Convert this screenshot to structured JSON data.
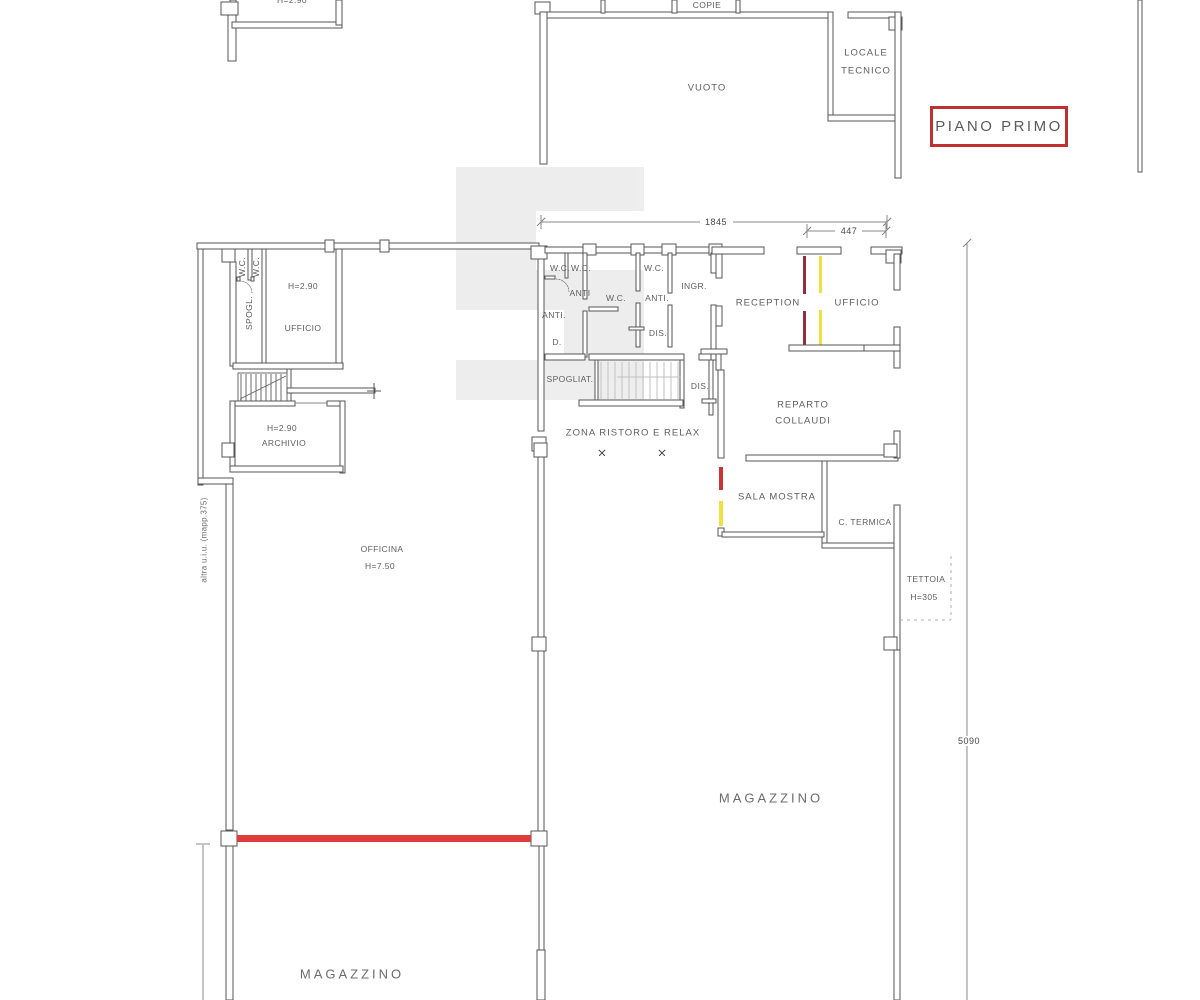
{
  "title_badge": {
    "label": "PIANO PRIMO"
  },
  "colors": {
    "title_border": "#c13030",
    "wall_line": "#565656",
    "demolition_dark_red": "#8e3039",
    "new_work_yellow": "#f2e13c",
    "highlight_red": "#e03c3c",
    "watermark_gray": "#d9d9d9"
  },
  "dimensions": {
    "top_width": "1845",
    "office_width": "447",
    "right_height": "5090"
  },
  "rooms": {
    "copie": "COPIE",
    "vuoto": "VUOTO",
    "locale_tecnico_line1": "LOCALE",
    "locale_tecnico_line2": "TECNICO",
    "height_top_left": "H=2.90",
    "wc_a": "W.C.",
    "wc_b": "W.C.",
    "spogl": "SPOGL.",
    "ufficio_left_height": "H=2.90",
    "ufficio_left": "UFFICIO",
    "archivio_height": "H=2.90",
    "archivio": "ARCHIVIO",
    "officina": "OFFICINA",
    "officina_height": "H=7.50",
    "wc_c": "W.C.",
    "wc_d": "W.C.",
    "anti_a": "ANTI",
    "anti_b": "ANTI.",
    "d_room": "D.",
    "wc_e": "W.C.",
    "wc_f": "W.C.",
    "anti_c": "ANTI.",
    "ingresso": "INGR.",
    "dis_a": "DIS.",
    "spogliatoio": "SPOGLIAT.",
    "dis_b": "DIS.",
    "zona_ristoro": "ZONA RISTORO E RELAX",
    "reception": "RECEPTION",
    "ufficio_right": "UFFICIO",
    "reparto_line1": "REPARTO",
    "reparto_line2": "COLLAUDI",
    "sala_mostra": "SALA MOSTRA",
    "c_termica": "C. TERMICA",
    "tettoia": "TETTOIA",
    "tettoia_height": "H=305",
    "magazzino_right": "MAGAZZINO",
    "magazzino_bottom": "MAGAZZINO"
  },
  "annotations": {
    "adjacent_unit": "altra u.i.u. (mapp.375)"
  }
}
